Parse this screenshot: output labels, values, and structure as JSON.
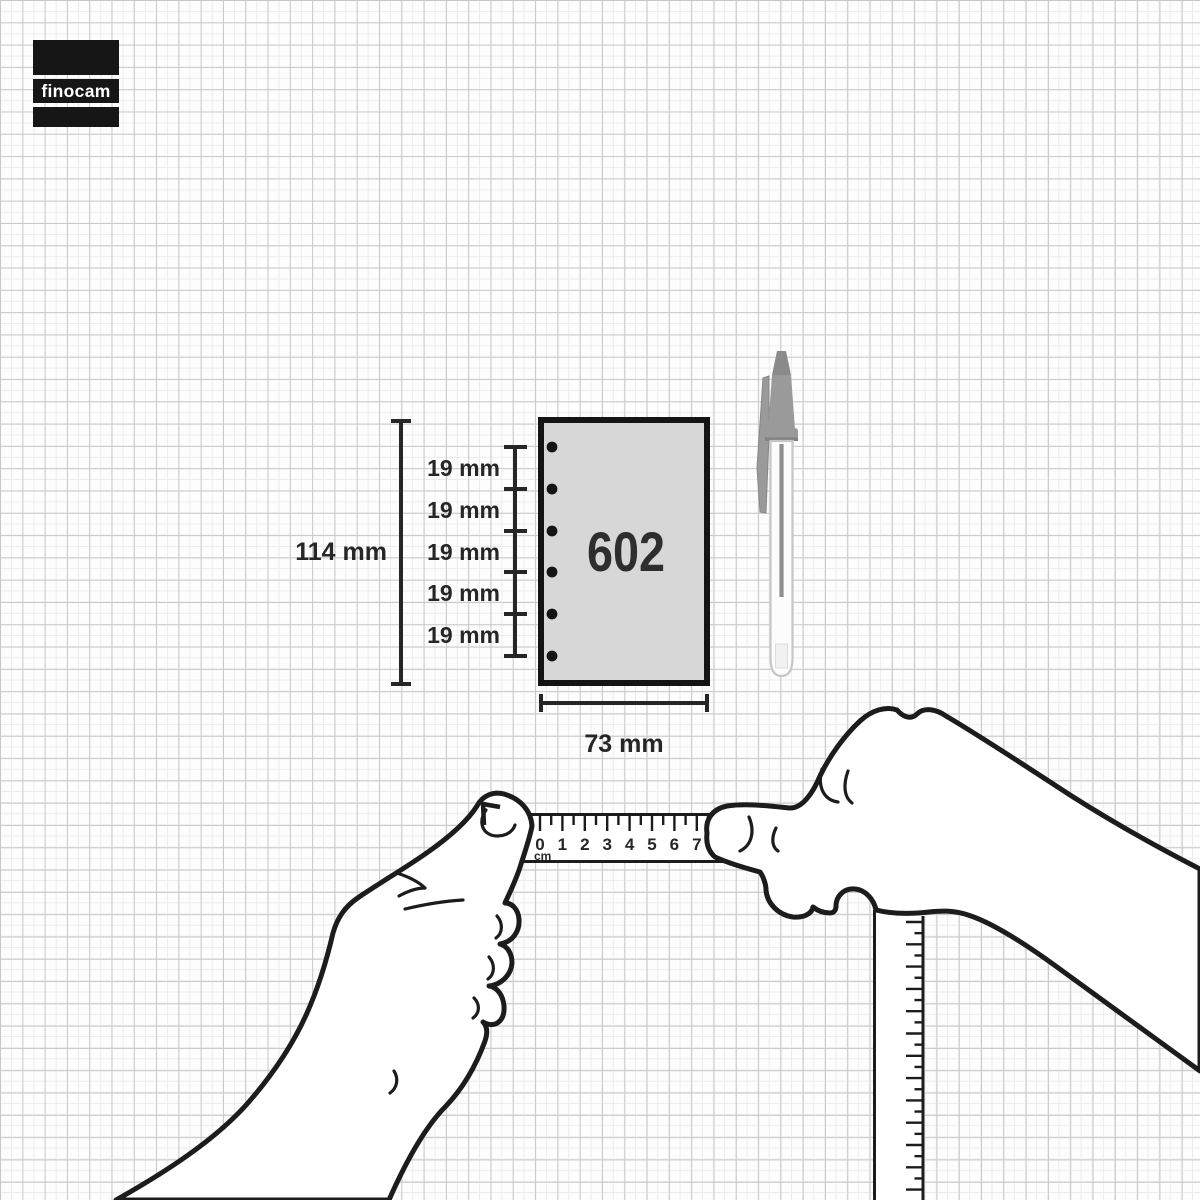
{
  "brand": {
    "logo_text": "finocam"
  },
  "annotations": {
    "page_height": "114 mm",
    "page_width": "73 mm",
    "hole_spacings": [
      "19 mm",
      "19 mm",
      "19 mm",
      "19 mm",
      "19 mm"
    ]
  },
  "sheet": {
    "product_code": "602",
    "hole_count": 6
  },
  "ruler": {
    "numbers": [
      "0",
      "1",
      "2",
      "3",
      "4",
      "5",
      "6",
      "7"
    ],
    "unit": "cm"
  },
  "colors": {
    "line": "#1c1c1c",
    "sheet_fill": "#d7d7d7",
    "logo_black": "#161616",
    "pen_cap": "#9a9a9a",
    "pen_tip": "#8a8a8a",
    "pen_ink": "#8f8f8f"
  }
}
